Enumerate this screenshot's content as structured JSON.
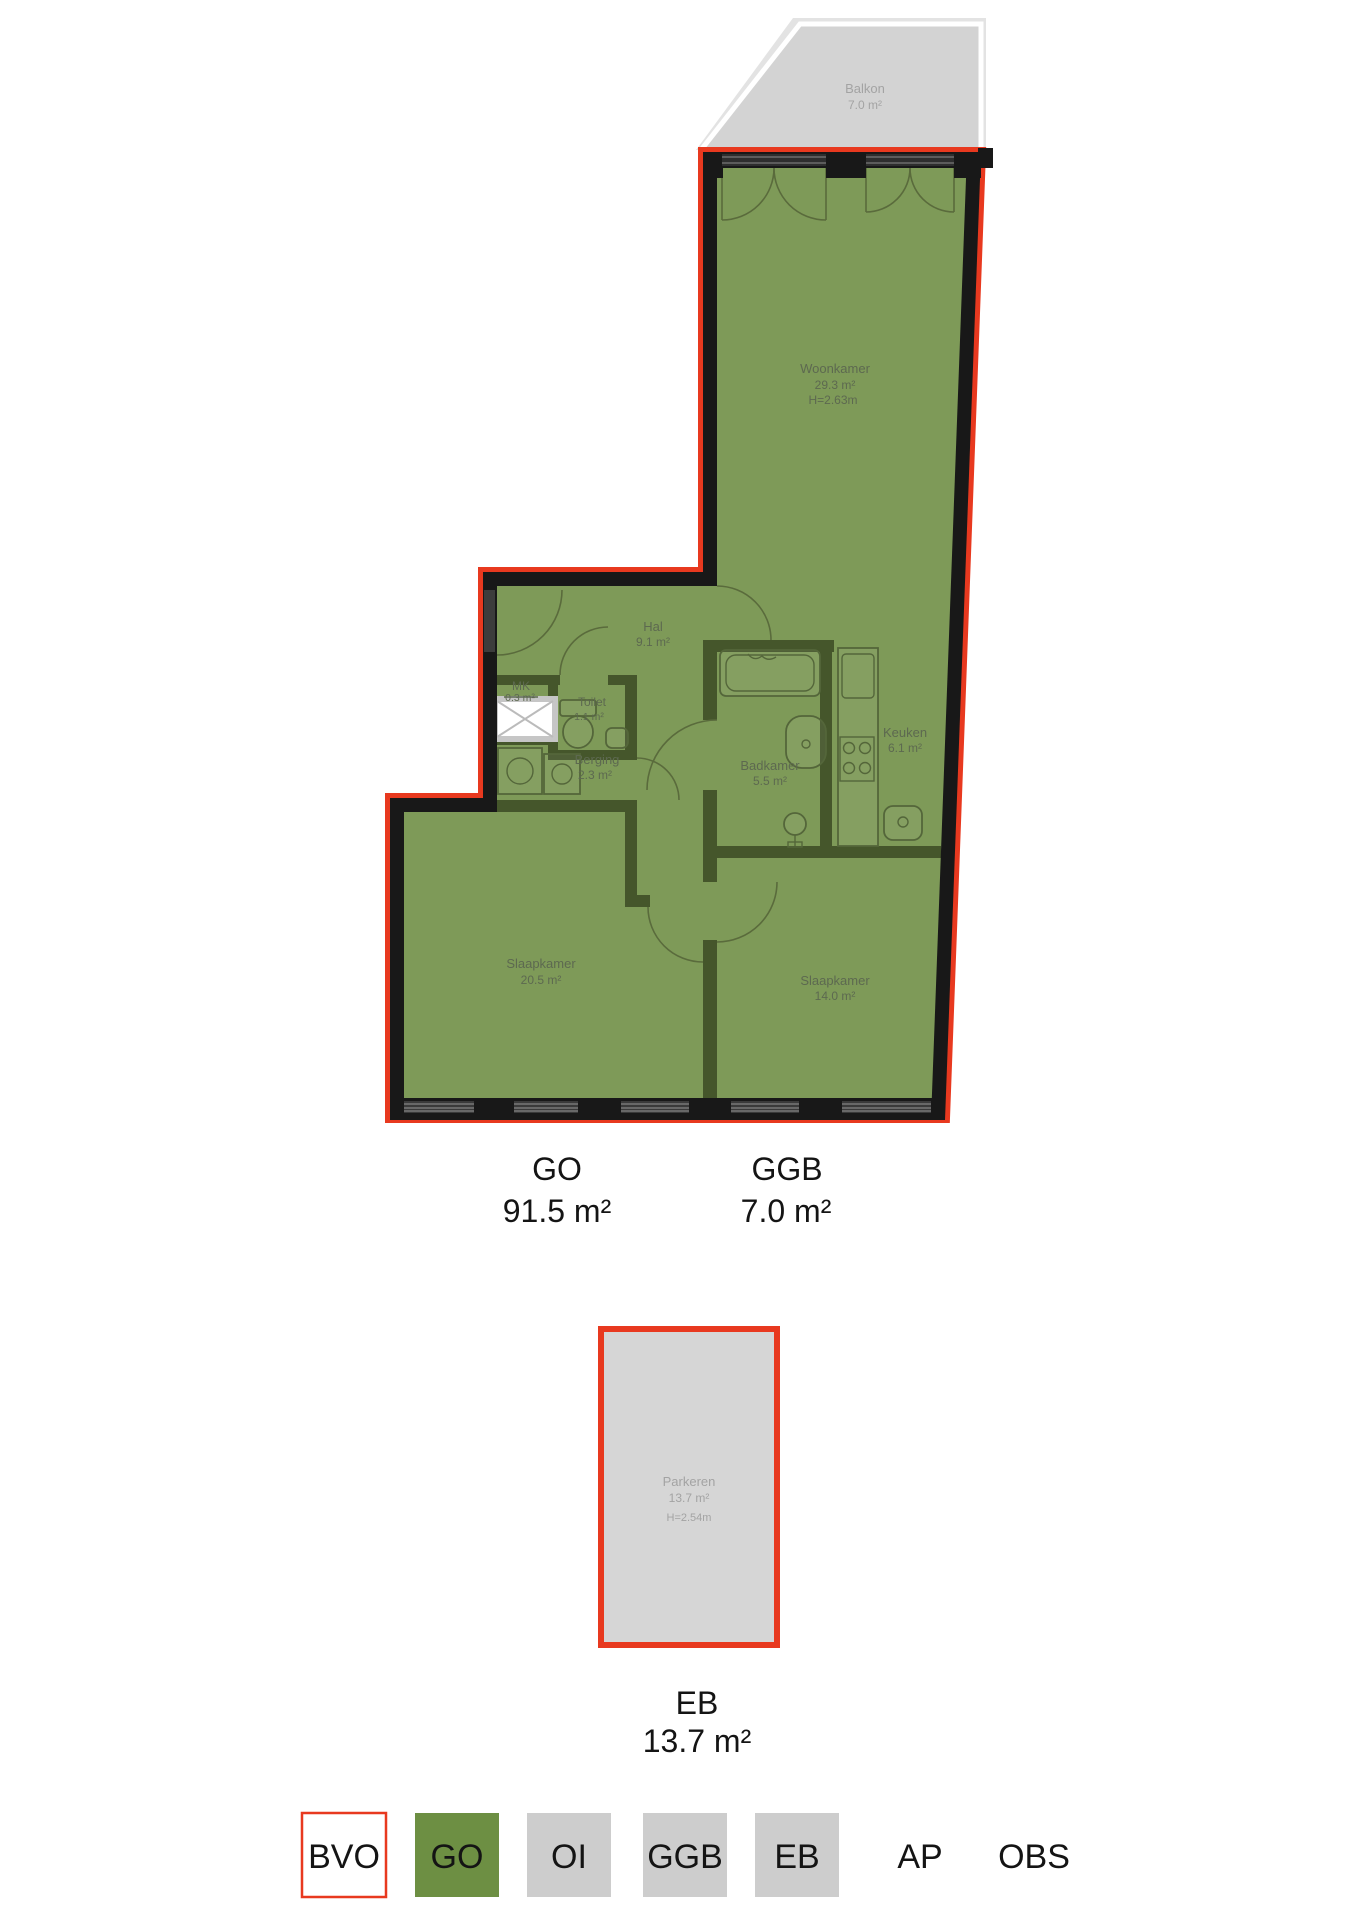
{
  "floorplan": {
    "rooms": {
      "balkon": {
        "name": "Balkon",
        "area": "7.0 m²"
      },
      "woonkamer": {
        "name": "Woonkamer",
        "area": "29.3 m²",
        "height": "H=2.63m"
      },
      "hal": {
        "name": "Hal",
        "area": "9.1 m²"
      },
      "mk": {
        "name": "MK",
        "area": "0.3 m²"
      },
      "toilet": {
        "name": "Toilet",
        "area": "1.1 m²"
      },
      "berging": {
        "name": "Berging",
        "area": "2.3 m²"
      },
      "badkamer": {
        "name": "Badkamer",
        "area": "5.5 m²"
      },
      "keuken": {
        "name": "Keuken",
        "area": "6.1 m²"
      },
      "slaapkamer_1": {
        "name": "Slaapkamer",
        "area": "20.5 m²"
      },
      "slaapkamer_2": {
        "name": "Slaapkamer",
        "area": "14.0 m²"
      },
      "parkeren": {
        "name": "Parkeren",
        "area": "13.7 m²",
        "height": "H=2.54m"
      }
    },
    "summary": {
      "go": {
        "label": "GO",
        "area": "91.5 m²"
      },
      "ggb": {
        "label": "GGB",
        "area": "7.0 m²"
      },
      "eb": {
        "label": "EB",
        "area": "13.7 m²"
      }
    },
    "legend": {
      "items": [
        {
          "label": "BVO",
          "fill": "#ffffff"
        },
        {
          "label": "GO",
          "fill": "#6d8f43"
        },
        {
          "label": "OI",
          "fill": "#cdcdcd"
        },
        {
          "label": "GGB",
          "fill": "#cdcdcd"
        },
        {
          "label": "EB",
          "fill": "#cdcdcd"
        },
        {
          "label": "AP",
          "fill": "none"
        },
        {
          "label": "OBS",
          "fill": "none"
        }
      ]
    },
    "colors": {
      "bvo_outline_red": "#e8391f",
      "go_fill_green": "#7e9a58",
      "legend_green": "#6d8f43",
      "area_gray": "#cdcdcd",
      "exterior_wall_black": "#181818",
      "interior_wall_olive": "#45562b",
      "balkon_gray": "#d3d3d3",
      "parkeren_gray": "#d6d6d6"
    }
  }
}
